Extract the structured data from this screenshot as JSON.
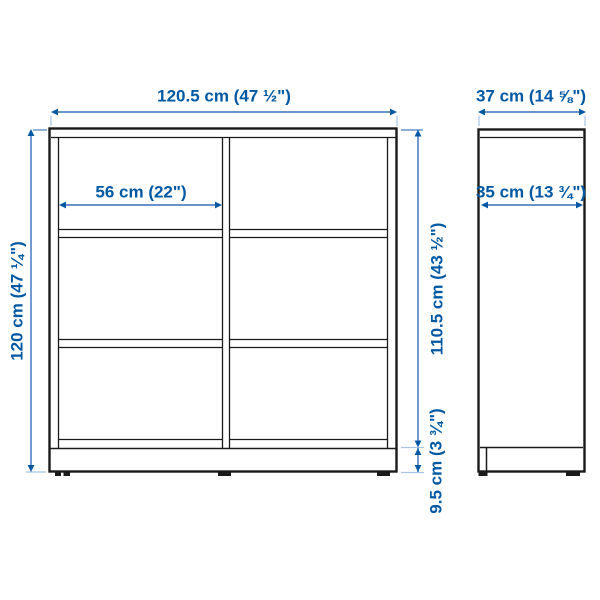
{
  "colors": {
    "dimension_text_blue": "#0058A3",
    "dimension_line_blue": "#3a6fba",
    "extension_line_light_blue": "#a5c4e6",
    "outline_dark": "#1a1a1a",
    "background": "#ffffff"
  },
  "front_view": {
    "width_total": "120.5 cm (47 ½\")",
    "inner_width": "56 cm (22\")",
    "height_total": "120 cm (47 ¼\")",
    "inner_height": "110.5 cm (43 ½\")",
    "base_height": "9.5 cm (3 ¾\")"
  },
  "side_view": {
    "depth_total": "37 cm (14 ⅝\")",
    "inner_depth": "35 cm (13 ¾\")"
  }
}
